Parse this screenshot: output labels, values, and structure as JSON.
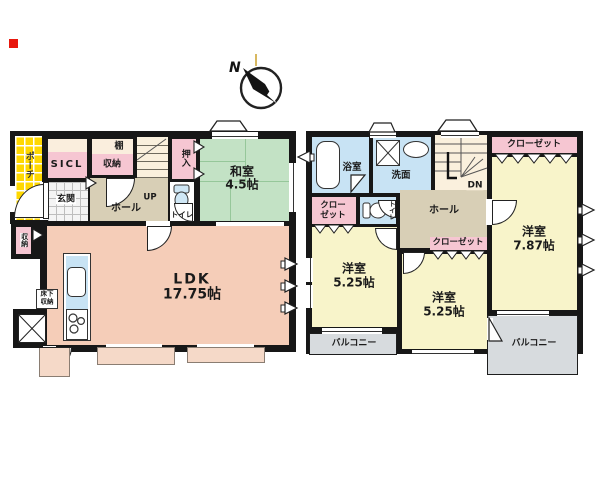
{
  "compass": {
    "north": "N"
  },
  "f1": {
    "porch": "ポーチ",
    "sicl": "SICL",
    "tana": "棚",
    "shuno": "収納",
    "genkan": "玄関",
    "hall": "ホール",
    "up": "UP",
    "toilet": "トイレ",
    "oshiire": "押入",
    "washitsu": "和室",
    "washitsu_size": "4.5帖",
    "ldk": "LDK",
    "ldk_size": "17.75帖",
    "side_shuno": "収納",
    "yukashita1": "床下",
    "yukashita2": "収納"
  },
  "f2": {
    "bath": "浴室",
    "senmen": "洗面",
    "dn": "DN",
    "closet_top": "クローゼット",
    "room_r": "洋室",
    "room_r_size": "7.87帖",
    "closet_left1": "クロー",
    "closet_left2": "ゼット",
    "toilet": "トイレ",
    "hall": "ホール",
    "closet_mid": "クローゼット",
    "room_l": "洋室",
    "room_l_size": "5.25帖",
    "room_m": "洋室",
    "room_m_size": "5.25帖",
    "balcony_l": "バルコニー",
    "balcony_r": "バルコニー"
  },
  "colors": {
    "wall": "#171717",
    "porch_yellow": "#ffd800",
    "closet_pink": "#f6c6d2",
    "cream": "#faeedd",
    "hall_tan": "#d8cfb6",
    "tatami_green": "#c3e2c5",
    "ldk_salmon": "#f5cdb8",
    "water_blue": "#c8e3f4",
    "room_yellow": "#f8f4ca",
    "balcony_gray": "#d7dbde",
    "terrace_peach": "#f5d9c8",
    "marker_red": "#e8170d"
  }
}
